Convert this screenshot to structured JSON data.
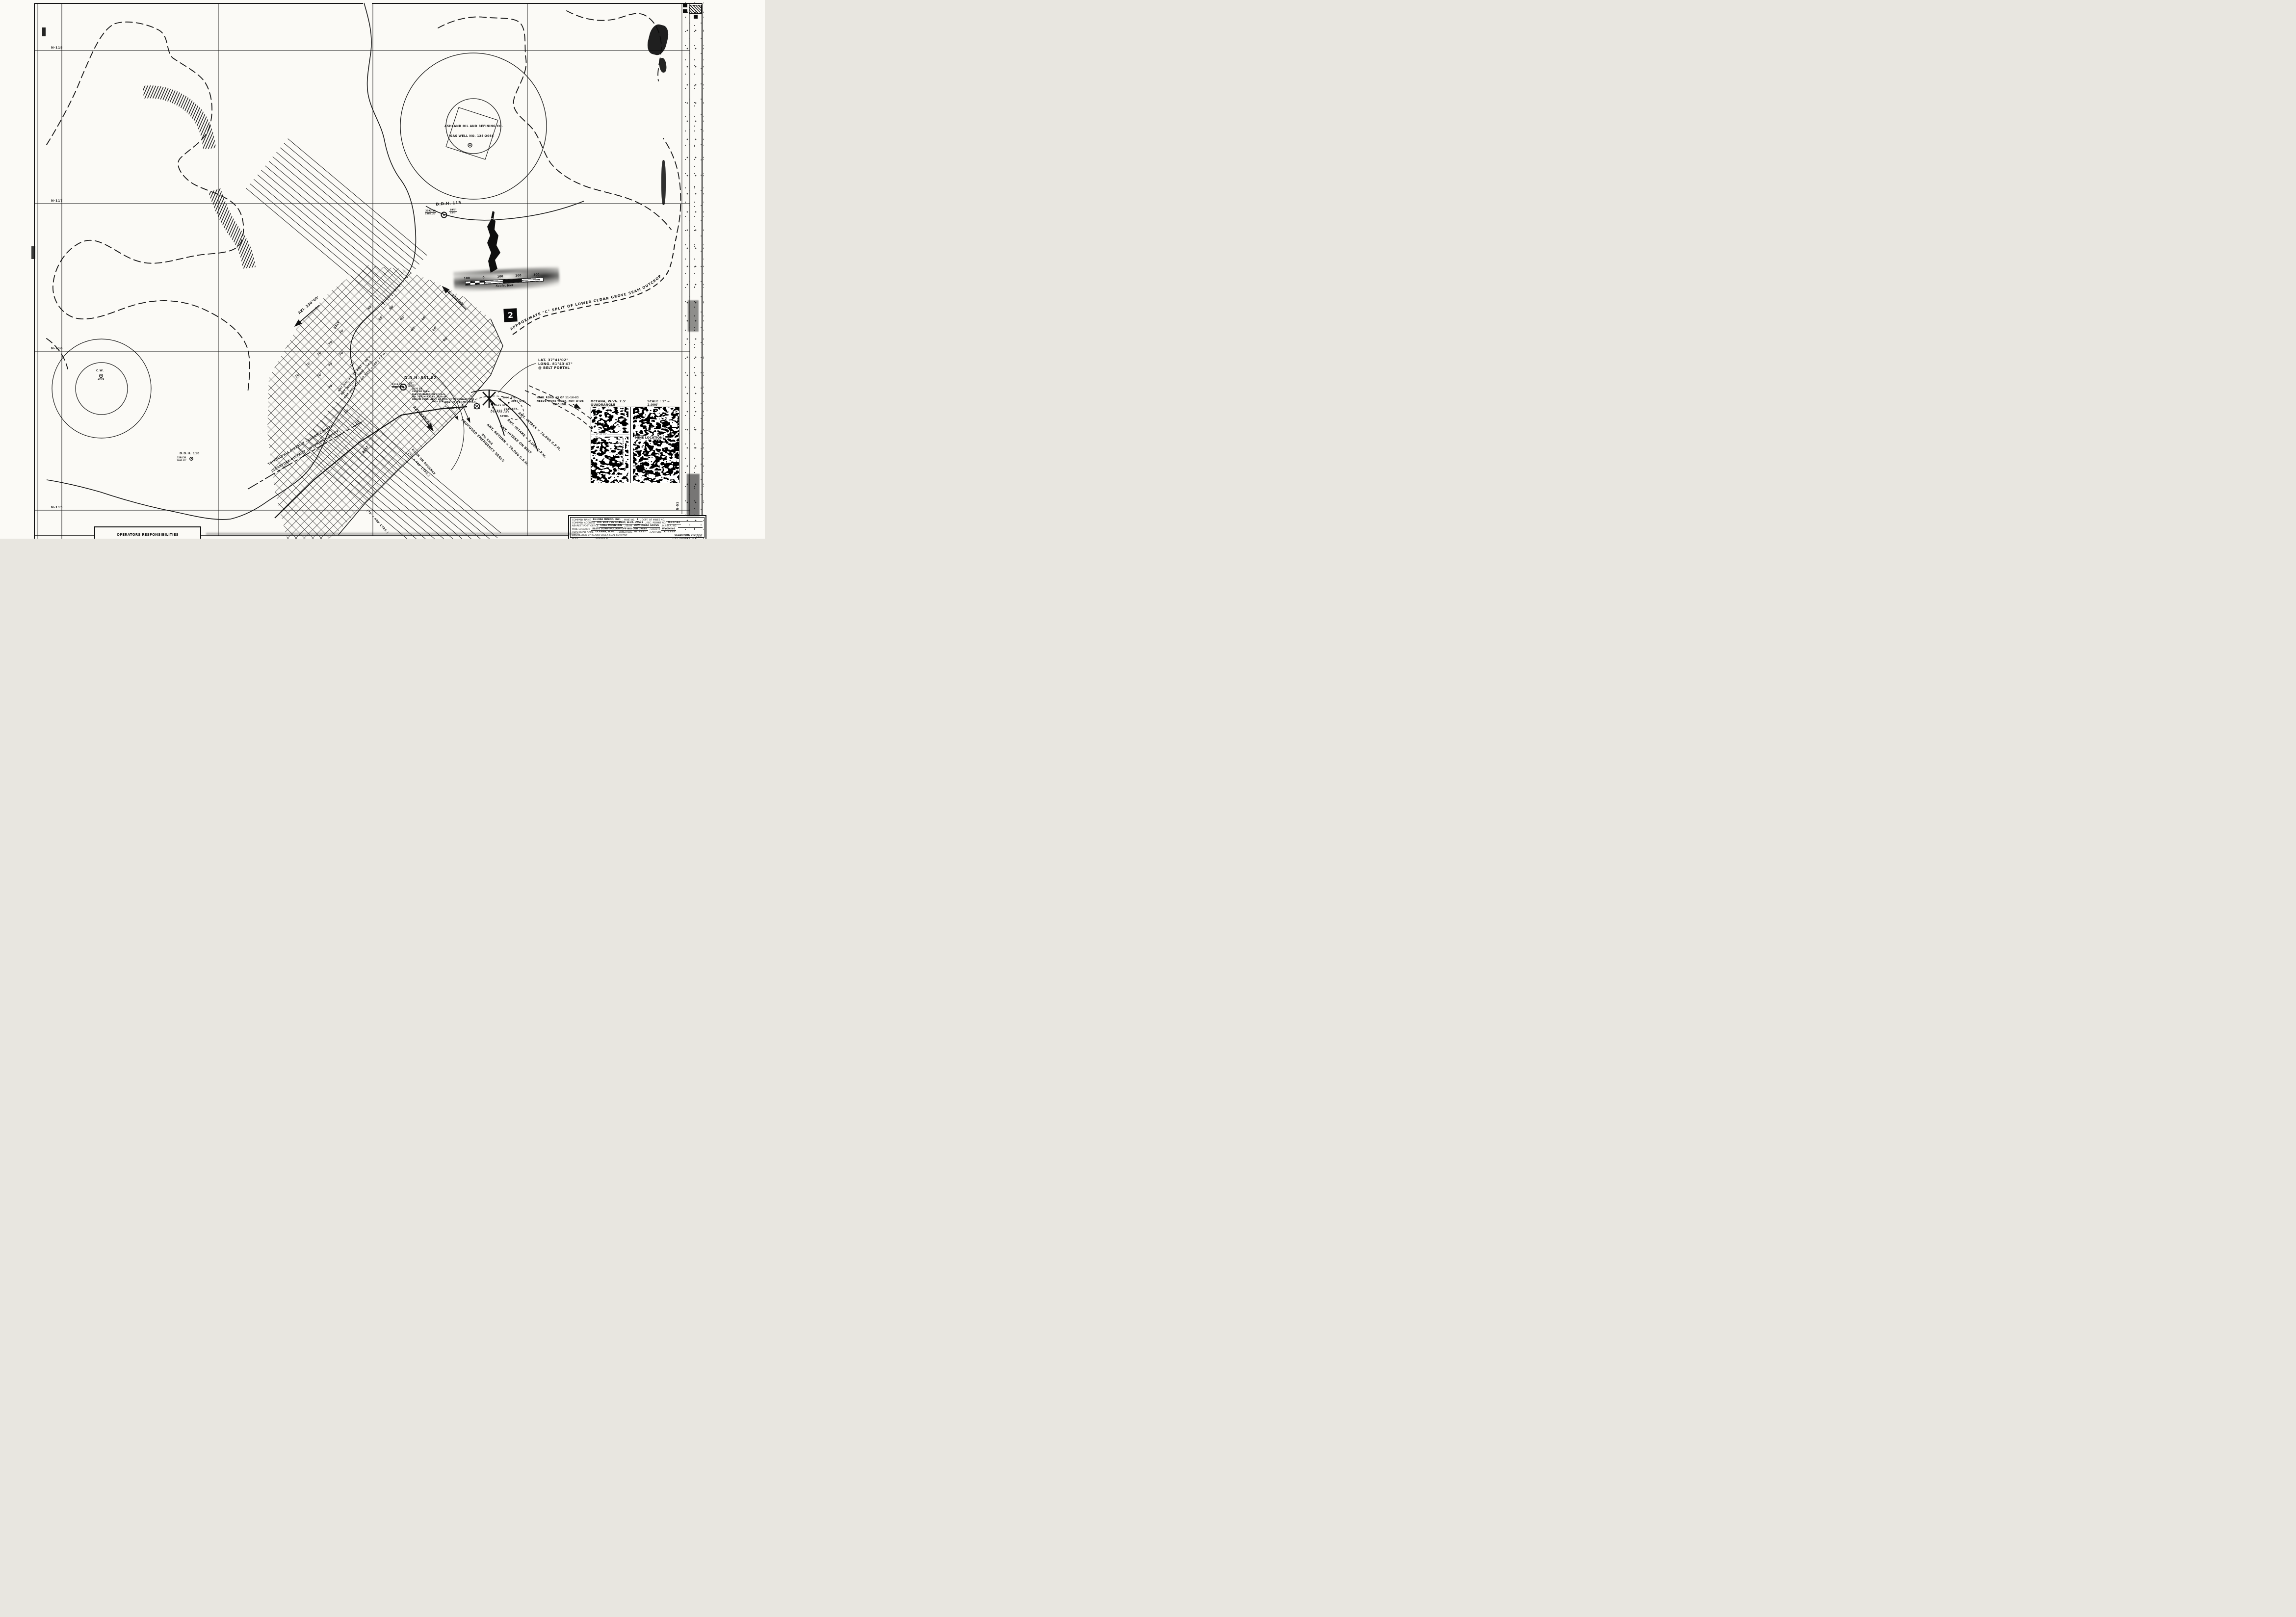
{
  "page": {
    "paper": "#fbfaf6",
    "ink": "#161616"
  },
  "margin": {
    "grid_labels": [
      "N-118",
      "N-117",
      "N-116",
      "N-115"
    ],
    "right_label": "N-51"
  },
  "gas_well": {
    "line1": "ASHLAND OIL AND REFINING CO.",
    "line2": "GAS WELL NO. 124-2068"
  },
  "cw_well": {
    "name": "C.W.",
    "number": "#19"
  },
  "ddh115": {
    "title": "D.D.H. 115",
    "elev_top": "2192.49",
    "elev_bottom": "1886.20'",
    "thick_top": "49½\"",
    "thick_bottom": "32½\""
  },
  "ddh118": {
    "title": "D.D.H. 118",
    "elev_top": "2284.50",
    "elev_bottom": "1892.07'"
  },
  "ddh881": {
    "title": "D.D.H. 881-82",
    "elev_top": "2124.19",
    "elev_bottom": "1904.77'",
    "thick_top": "56\"",
    "thick_bottom": "4.65'",
    "notes": [
      "3276 T.P.",
      "2122.60' ELEV.",
      "ELEV. IS BASED ON U.S.G.S.",
      "NO. 76 R.M.P. ELEV. 1320.46'",
      "DISC IN CONC. ABUT. AT MTH. OF MCDONALD FORK",
      "300± STK."
    ]
  },
  "scalebar": {
    "t0": "100",
    "t1": "0",
    "t2": "100",
    "t3": "200",
    "t4": "300",
    "caption": "Scale, feet"
  },
  "sheet_number": "2",
  "outcrop_label": "APPROXIMATE \"C\" SPLIT OF LOWER CEDAR GROVE SEAM OUTCROP",
  "district": {
    "upper": "TRIADELPHIA DISTRICT - LOGAN COUNTY",
    "lower": "CLEARFORK DISTRICT - WYOMING COUNTY"
  },
  "azimuth": {
    "az230": "AZI. 230°00'",
    "az320": "AZI. 320°00'",
    "az140": "AZI. 140°00'"
  },
  "belt": {
    "label": "BELT",
    "note1": "ANT. SM. HT. ON BELT = 38\"±",
    "note2": "ANT. WIDTH ON BELT = 16'±",
    "note3": "ANT. VELOCITY ON BELT = 560± F.P.M."
  },
  "portal": {
    "lat": "LAT. 37°41'02\"",
    "long": "LONG. 81°43'47\"",
    "at": "@ BELT PORTAL",
    "end_permit": "END OF PERMIT MKR.",
    "tp": "3042 T.P.",
    "stk1": "3044 STK.",
    "stk2": "3040 STK.",
    "stk3": "3043 STK.",
    "stk4": "3046 STK.",
    "access": "ACCESS RD.",
    "spoil": "SPOIL",
    "haul1": "HAUL ROAD AS OF 11-16-83",
    "haul2": "NEEDS MORE WORK, NOT WIDE",
    "haul3": "ENOUGH."
  },
  "vent": {
    "seals": "PROPOSED EMERGENCY SEALS",
    "return79": "ANT. RETURN = 79,000 C.F.M.",
    "ch4": "0% CH4",
    "intake3000": "ANT. INTAKE = 3,000 C.F.M.",
    "intake_belt": "ANT. INTAKE ON BELT",
    "intake76": "ANT. INTAKE = 76,000 C.F.M."
  },
  "rooms": {
    "advance1": "ROOM ON ADVANCE",
    "advance2": "(70' x 480' CTRS.)",
    "retreat": "(70' x 480' CTRS.)"
  },
  "dims": {
    "d70": "70'",
    "d60": "60'"
  },
  "inset": {
    "title": "OCEANA, W.VA. 7.5' QUADRANGLE",
    "scale": "SCALE : 1\" = 2,000'",
    "mine_location": "MINE LOCATION",
    "longitude": "LONGITUDE = 81°43'47\"",
    "latitude": "37°41'02\""
  },
  "title_block": {
    "r1a": "COMPANY NAME",
    "r1b": "RU-MAE MINING, INC.",
    "r1c": ", MINE NO.",
    "r1d": "1",
    "r1e": ", DEPT. OF MINES NO.",
    "r2a": "COMPANY ADDRESS",
    "r2b": "P.O. BOX 786 GILBERT, W.VA. 25621",
    "r2c": ", REC. PERMIT NO.",
    "r2d": "U-177-83",
    "r3a": "NEAREST POST OFFICE",
    "r3b": "COAL MOUNTAIN",
    "r3c": ", SEAM",
    "r3d": "LOW CEDAR GROVE",
    "r3e": ", M.S.H.A. NO.",
    "r4a": "MINE LOCATION",
    "r4b": "SLATE DUMP HOLLOW OFF BIG CUB CREEK",
    "r4c": ", COUNTY",
    "r4d": "WYOMING",
    "r5a": "TOPO QUAD NAME",
    "r5b": "OCEANA, W.VA.",
    "r5c": ", LONGITUDE",
    "r5d": "81°43'47\"",
    "r5e": ", LATITUDE",
    "r5f": "37°41'02\"",
    "r6a": "ENGINEERED BY ISLAND CREEK COAL COMPANY",
    "r6b": "CLEARFORK DISTRICT",
    "r7a": "DATE",
    "r7b": ", DRAWN BY",
    "r7c": ", MAP SCALE : 1\" =",
    "r7d": "100'"
  },
  "operators_box": {
    "title": "OPERATORS RESPONSIBILITIES"
  }
}
